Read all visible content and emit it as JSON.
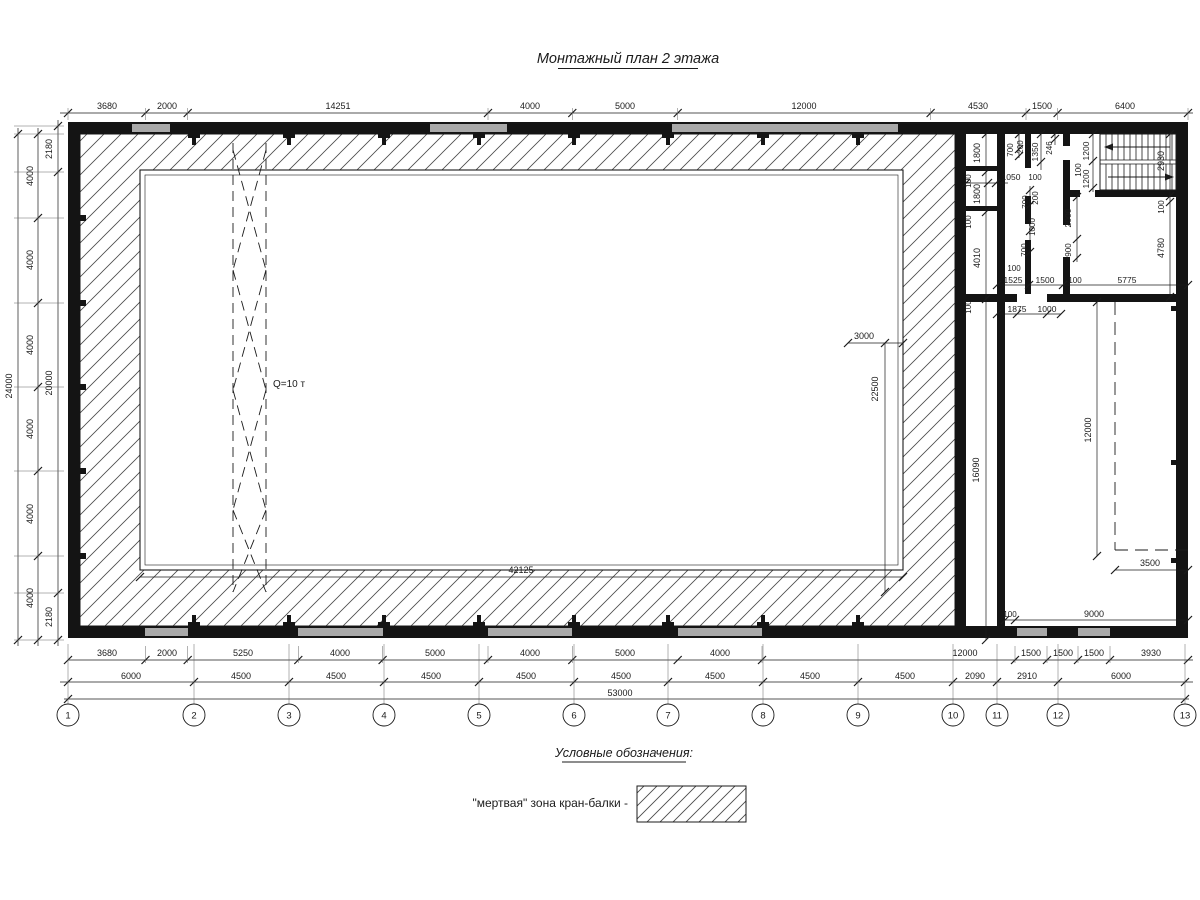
{
  "title": "Монтажный план 2 этажа",
  "legend": {
    "heading": "Условные обозначения:",
    "item_label": "\"мертвая\" зона кран-балки -"
  },
  "colors": {
    "ink": "#1b1b1b",
    "wall": "#141414",
    "window": "#a9a9a9",
    "paper": "#ffffff"
  },
  "grid_bubbles": [
    "1",
    "2",
    "3",
    "4",
    "5",
    "6",
    "7",
    "8",
    "9",
    "10",
    "11",
    "12",
    "13"
  ],
  "crane_capacity_label": "Q=10 т",
  "overall_dims": {
    "length": "53000",
    "width": "24000",
    "hall_span": "42125"
  },
  "annotations": [
    {
      "t": "3680",
      "x": 107,
      "y": 109
    },
    {
      "t": "2000",
      "x": 167,
      "y": 109
    },
    {
      "t": "14251",
      "x": 338,
      "y": 109
    },
    {
      "t": "4000",
      "x": 530,
      "y": 109
    },
    {
      "t": "5000",
      "x": 625,
      "y": 109
    },
    {
      "t": "12000",
      "x": 804,
      "y": 109
    },
    {
      "t": "4530",
      "x": 978,
      "y": 109
    },
    {
      "t": "1500",
      "x": 1042,
      "y": 109
    },
    {
      "t": "6400",
      "x": 1125,
      "y": 109
    },
    {
      "t": "3680",
      "x": 107,
      "y": 656
    },
    {
      "t": "2000",
      "x": 167,
      "y": 656
    },
    {
      "t": "5250",
      "x": 243,
      "y": 656
    },
    {
      "t": "4000",
      "x": 340,
      "y": 656
    },
    {
      "t": "5000",
      "x": 435,
      "y": 656
    },
    {
      "t": "4000",
      "x": 530,
      "y": 656
    },
    {
      "t": "5000",
      "x": 625,
      "y": 656
    },
    {
      "t": "4000",
      "x": 720,
      "y": 656
    },
    {
      "t": "12000",
      "x": 965,
      "y": 656
    },
    {
      "t": "1500",
      "x": 1031,
      "y": 656
    },
    {
      "t": "1500",
      "x": 1063,
      "y": 656
    },
    {
      "t": "1500",
      "x": 1094,
      "y": 656
    },
    {
      "t": "3930",
      "x": 1151,
      "y": 656
    },
    {
      "t": "6000",
      "x": 131,
      "y": 679
    },
    {
      "t": "4500",
      "x": 241,
      "y": 679
    },
    {
      "t": "4500",
      "x": 336,
      "y": 679
    },
    {
      "t": "4500",
      "x": 431,
      "y": 679
    },
    {
      "t": "4500",
      "x": 526,
      "y": 679
    },
    {
      "t": "4500",
      "x": 621,
      "y": 679
    },
    {
      "t": "4500",
      "x": 715,
      "y": 679
    },
    {
      "t": "4500",
      "x": 810,
      "y": 679
    },
    {
      "t": "4500",
      "x": 905,
      "y": 679
    },
    {
      "t": "2090",
      "x": 975,
      "y": 679
    },
    {
      "t": "2910",
      "x": 1027,
      "y": 679
    },
    {
      "t": "6000",
      "x": 1121,
      "y": 679
    },
    {
      "t": "53000",
      "x": 620,
      "y": 696
    },
    {
      "t": "24000",
      "x": 12,
      "y": 386,
      "r": -90
    },
    {
      "t": "4000",
      "x": 33,
      "y": 176,
      "r": -90
    },
    {
      "t": "4000",
      "x": 33,
      "y": 260,
      "r": -90
    },
    {
      "t": "4000",
      "x": 33,
      "y": 345,
      "r": -90
    },
    {
      "t": "4000",
      "x": 33,
      "y": 429,
      "r": -90
    },
    {
      "t": "4000",
      "x": 33,
      "y": 514,
      "r": -90
    },
    {
      "t": "4000",
      "x": 33,
      "y": 598,
      "r": -90
    },
    {
      "t": "2180",
      "x": 52,
      "y": 149,
      "r": -90
    },
    {
      "t": "20000",
      "x": 52,
      "y": 383,
      "r": -90
    },
    {
      "t": "2180",
      "x": 52,
      "y": 617,
      "r": -90
    },
    {
      "t": "42125",
      "x": 521,
      "y": 573
    },
    {
      "t": "3000",
      "x": 864,
      "y": 339
    },
    {
      "t": "22500",
      "x": 878,
      "y": 389,
      "r": -90
    },
    {
      "t": "Q=10 т",
      "x": 273,
      "y": 387,
      "a": "start",
      "s": 10
    },
    {
      "t": "1800",
      "x": 980,
      "y": 153,
      "r": -90
    },
    {
      "t": "100",
      "x": 971,
      "y": 181,
      "r": -90,
      "s": 8
    },
    {
      "t": "1800",
      "x": 980,
      "y": 194,
      "r": -90
    },
    {
      "t": "100",
      "x": 971,
      "y": 222,
      "r": -90,
      "s": 8
    },
    {
      "t": "4010",
      "x": 980,
      "y": 258,
      "r": -90
    },
    {
      "t": "100",
      "x": 971,
      "y": 307,
      "r": -90,
      "s": 8
    },
    {
      "t": "16090",
      "x": 979,
      "y": 470,
      "r": -90
    },
    {
      "t": "1050",
      "x": 1011,
      "y": 180,
      "s": 8.5
    },
    {
      "t": "100",
      "x": 1035,
      "y": 180,
      "s": 8
    },
    {
      "t": "700",
      "x": 1013,
      "y": 150,
      "r": -90,
      "s": 8
    },
    {
      "t": "200",
      "x": 1023,
      "y": 147,
      "r": -90,
      "s": 8
    },
    {
      "t": "1350",
      "x": 1038,
      "y": 152,
      "r": -90,
      "s": 8.5
    },
    {
      "t": "246",
      "x": 1052,
      "y": 148,
      "r": -90,
      "s": 8
    },
    {
      "t": "700",
      "x": 1028,
      "y": 202,
      "r": -90,
      "s": 8
    },
    {
      "t": "200",
      "x": 1038,
      "y": 198,
      "r": -90,
      "s": 8
    },
    {
      "t": "1000",
      "x": 1035,
      "y": 227,
      "r": -90,
      "s": 8
    },
    {
      "t": "700",
      "x": 1027,
      "y": 250,
      "r": -90,
      "s": 8
    },
    {
      "t": "2000",
      "x": 1071,
      "y": 218,
      "r": -90,
      "s": 8.5
    },
    {
      "t": "900",
      "x": 1071,
      "y": 250,
      "r": -90,
      "s": 8
    },
    {
      "t": "1200",
      "x": 1089,
      "y": 151,
      "r": -90,
      "s": 8.5
    },
    {
      "t": "100",
      "x": 1081,
      "y": 170,
      "r": -90,
      "s": 8
    },
    {
      "t": "1200",
      "x": 1089,
      "y": 179,
      "r": -90,
      "s": 8.5
    },
    {
      "t": "2930",
      "x": 1164,
      "y": 161,
      "r": -90
    },
    {
      "t": "100",
      "x": 1164,
      "y": 207,
      "r": -90,
      "s": 8
    },
    {
      "t": "4780",
      "x": 1164,
      "y": 248,
      "r": -90
    },
    {
      "t": "100",
      "x": 1014,
      "y": 271,
      "s": 8
    },
    {
      "t": "1525",
      "x": 1013,
      "y": 283,
      "s": 8.5
    },
    {
      "t": "1500",
      "x": 1045,
      "y": 283,
      "s": 8.5
    },
    {
      "t": "100",
      "x": 1075,
      "y": 283,
      "s": 8
    },
    {
      "t": "5775",
      "x": 1127,
      "y": 283,
      "s": 8.5
    },
    {
      "t": "1875",
      "x": 1017,
      "y": 312,
      "s": 8.5
    },
    {
      "t": "1000",
      "x": 1047,
      "y": 312,
      "s": 8.5
    },
    {
      "t": "12000",
      "x": 1091,
      "y": 430,
      "r": -90
    },
    {
      "t": "3500",
      "x": 1150,
      "y": 566
    },
    {
      "t": "100",
      "x": 1010,
      "y": 617,
      "s": 8
    },
    {
      "t": "9000",
      "x": 1094,
      "y": 617
    }
  ]
}
